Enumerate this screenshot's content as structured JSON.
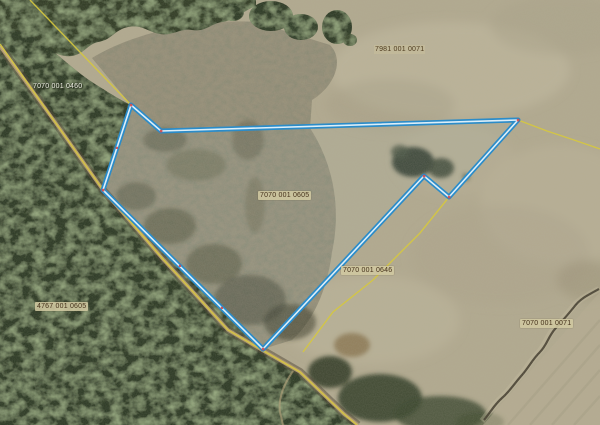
{
  "app": {
    "name": "cadastral-map-viewer",
    "view": "aerial-imagery-with-cadastre"
  },
  "map": {
    "selected_parcel": {
      "id": "7070 001 0605",
      "outline_points": "131,105 161,131 518,120 449,197 424,176 263,349 103,190",
      "highlight_color": "#2b8cc9"
    },
    "boundary_line_color": "#d6c83e",
    "cadastral_lines": [
      {
        "name": "road-boundary-line",
        "points": "0,44 55,122 103,190 162,258 228,330 262,350 300,372 344,414 357,425"
      },
      {
        "name": "northwest-boundary-line",
        "points": "30,0 78,50 131,105"
      },
      {
        "name": "northeast-boundary-line",
        "points": "518,120 547,131 574,140 600,149"
      },
      {
        "name": "southeast-boundary-line",
        "points": "449,197 420,233 373,280 333,312 303,352"
      }
    ],
    "labels": [
      {
        "id": "parcel-nw",
        "text": "7070 001 0460"
      },
      {
        "id": "parcel-ne",
        "text": "7981 001 0071"
      },
      {
        "id": "parcel-selected",
        "text": "7070 001 0605"
      },
      {
        "id": "parcel-s",
        "text": "7070 001 0646"
      },
      {
        "id": "parcel-sw",
        "text": "4767 001 0605"
      },
      {
        "id": "parcel-se",
        "text": "7070 001 0071"
      }
    ]
  }
}
